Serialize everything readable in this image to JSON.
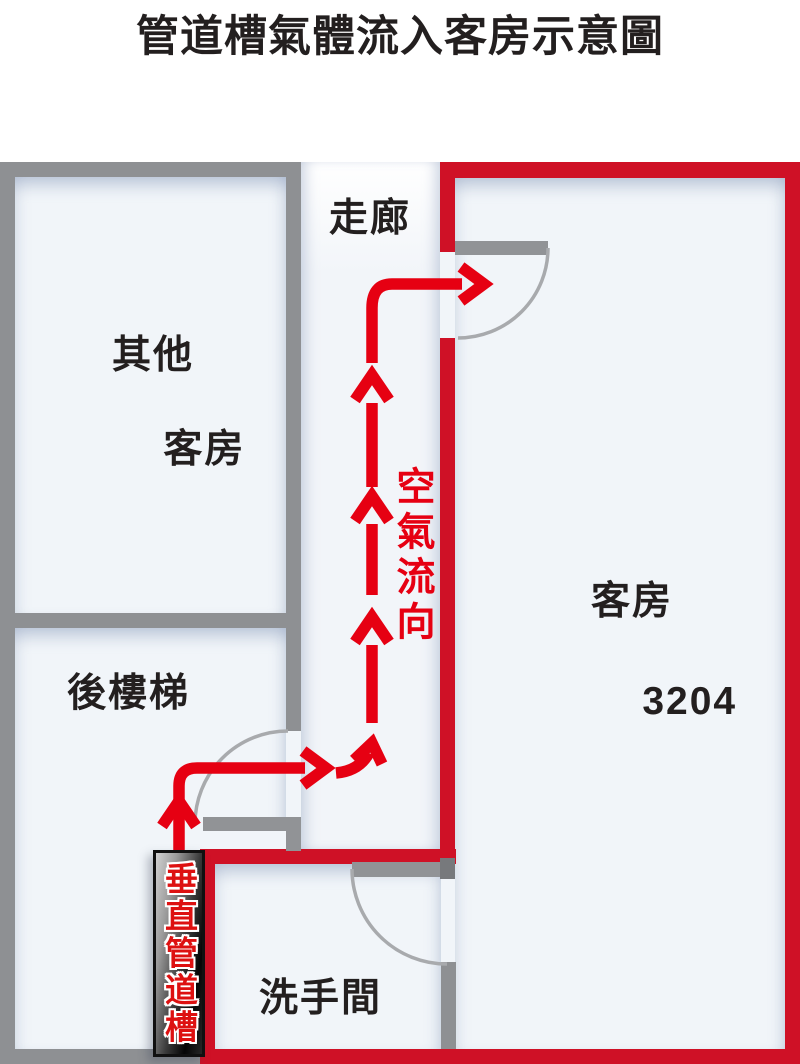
{
  "title": "管道槽氣體流入客房示意圖",
  "labels": {
    "corridor": "走廊",
    "other_room_line1": "其他",
    "other_room_line2": "客房",
    "room_3204_line1": "客房",
    "room_3204_line2": "3204",
    "back_stairs": "後樓梯",
    "washroom": "洗手間",
    "air_flow": "空氣流向",
    "vertical_duct": "垂直管道槽"
  },
  "colors": {
    "wall_gray": "#8e9093",
    "wall_red": "#cf1126",
    "arrow_red": "#e60012",
    "room_fill": "#f1f5f9",
    "duct_text_red": "#dd1111",
    "label_black": "#231f1f"
  }
}
